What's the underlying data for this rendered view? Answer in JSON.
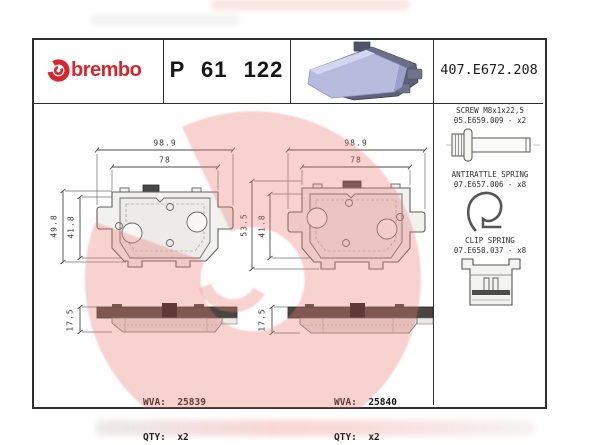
{
  "header": {
    "brand_wordmark": "brembo",
    "part_number": "P 61 122",
    "catalog_code": "407.E672.208"
  },
  "accessories": {
    "screw": {
      "name": "SCREW M8x1x22,5",
      "code": "05.E659.009 - x2"
    },
    "antirattle_spring": {
      "name": "ANTIRATTLE SPRING",
      "code": "07.E657.006 - x8"
    },
    "clip_spring": {
      "name": "CLIP SPRING",
      "code": "07.E658.037 - x8"
    }
  },
  "pads": {
    "left": {
      "width_total": "98.9",
      "width_inner": "78",
      "height_total": "49.8",
      "height_inner": "41.8",
      "thickness": "17.5",
      "wva": "WVA:  25839",
      "qty": "QTY:  x2"
    },
    "right": {
      "width_total": "98.9",
      "width_inner": "78",
      "height_total": "53.5",
      "height_inner": "41.8",
      "thickness": "17.5",
      "wva": "WVA:  25840",
      "qty": "QTY:  x2"
    }
  },
  "colors": {
    "brand_red": "#d8262c",
    "watermark_pink": "rgba(234,124,113,0.34)",
    "line_gray": "#5f5f5f"
  }
}
